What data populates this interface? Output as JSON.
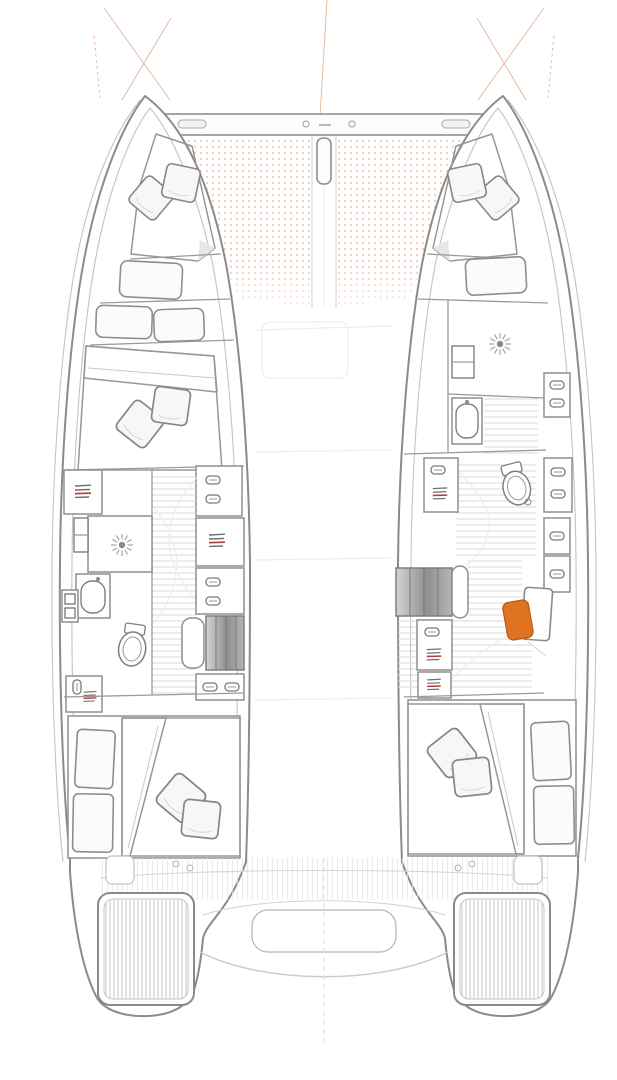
{
  "diagram": {
    "kind": "catamaran-floor-plan",
    "view": "top-down hull and deck layout, no text labels",
    "colors": {
      "background": "#ffffff",
      "hull_outline": "#8b8b8b",
      "mattress_fill": "#f8cfa7",
      "mattress_dot": "#e79a63",
      "trampoline_dot": "#f3c0a8",
      "pillow_fill": "#f7f7f7",
      "shelf_accent_red": "#b23f3a",
      "chair_orange": "#e0731f",
      "steps_light": "#d4d4d4",
      "steps_dark": "#8f8f8f",
      "floor_line": "#dadada",
      "guide_red": "#e2a88f"
    },
    "foredeck": {
      "elements": [
        "crossbeam",
        "bowsprit-fitting",
        "trampoline-port",
        "trampoline-starboard",
        "rigging-guide-lines"
      ]
    },
    "port_hull": {
      "areas": [
        "forepeak-berth",
        "forward-double-cabin",
        "wardrobe-lockers",
        "shower",
        "washbasin",
        "toilet",
        "companionway-steps",
        "aft-double-cabin"
      ]
    },
    "starboard_hull": {
      "areas": [
        "forepeak-berth",
        "guest-berth-cushion",
        "shower",
        "washbasin",
        "toilet",
        "storage-lockers",
        "companionway-steps",
        "desk-with-chair",
        "aft-double-cabin"
      ]
    },
    "stern": {
      "elements": [
        "cockpit-slats",
        "aft-bench",
        "transom-steps-port",
        "transom-steps-starboard",
        "centerline"
      ]
    }
  }
}
